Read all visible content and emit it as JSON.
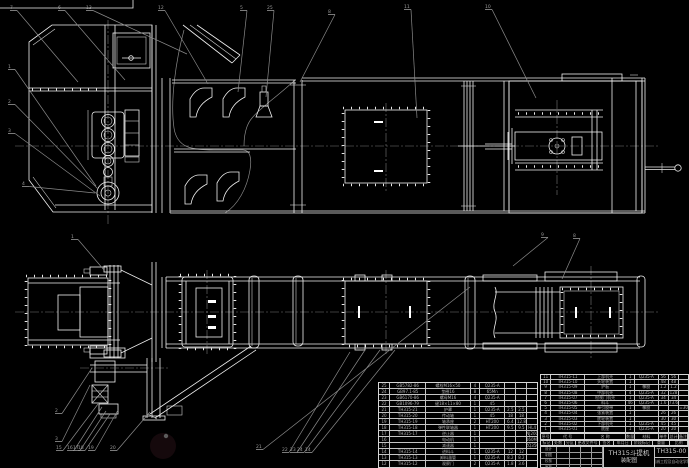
{
  "sheet": {
    "background": "#000000",
    "line_color": "#f0f0f0",
    "leader_color": "#8a8a8a",
    "watermark_color": "#463339"
  },
  "title_block": {
    "drawing_title": "TH315斗提机",
    "drawing_subtitle": "装配图",
    "drawing_number": "TH315-00",
    "organization": "机械工程及自动化学院",
    "sign_rows": [
      "设计",
      "制图",
      "校核",
      "审核"
    ],
    "revision_cells": [
      "标记",
      "处数",
      "分区",
      "更改文件号",
      "签名",
      "年月日",
      "阶段标记",
      "重量",
      "比例"
    ]
  },
  "bom_headers": [
    "序号",
    "代 号",
    "名 称",
    "数量",
    "材料",
    "单件",
    "总计",
    "备注"
  ],
  "bom_right_rows": [
    [
      "11",
      "TH315-11",
      "上部机壳",
      "1",
      "Q235-A",
      "56",
      "56",
      ""
    ],
    [
      "10",
      "TH315-10",
      "头轮装置",
      "1",
      "",
      "48",
      "48",
      ""
    ],
    [
      "9",
      "TH315-09",
      "护板",
      "1",
      "橡胶",
      "1.2",
      "1.2",
      ""
    ],
    [
      "8",
      "TH315-08",
      "中部机壳",
      "4",
      "Q235-A",
      "32",
      "128",
      ""
    ],
    [
      "7",
      "TH315-07",
      "检视门机壳",
      "1",
      "Q235-A",
      "34",
      "34",
      ""
    ],
    [
      "6",
      "TH315-06",
      "料斗",
      "46",
      "Q235-A",
      "1.6",
      "73.6",
      ""
    ],
    [
      "5",
      "TH315-05",
      "牵引胶带",
      "1",
      "橡胶",
      "",
      "",
      "B=300"
    ],
    [
      "4",
      "TH315-04",
      "张紧装置",
      "1",
      "",
      "26",
      "26",
      ""
    ],
    [
      "3",
      "TH315-03",
      "底轮装置",
      "1",
      "",
      "30",
      "30",
      ""
    ],
    [
      "2",
      "TH315-02",
      "下部机壳",
      "1",
      "Q235-A",
      "45",
      "45",
      ""
    ],
    [
      "1",
      "TH315-01",
      "底座",
      "1",
      "Q235-A",
      "20",
      "20",
      ""
    ]
  ],
  "bom_left_rows": [
    [
      "25",
      "GB5782-86",
      "螺栓M16×50",
      "4",
      "Q235-A",
      "",
      "",
      ""
    ],
    [
      "24",
      "GB97.1-85",
      "垫圈16",
      "8",
      "65Mn",
      "",
      "",
      ""
    ],
    [
      "23",
      "GB6170-86",
      "螺母M16",
      "4",
      "Q235-A",
      "",
      "",
      ""
    ],
    [
      "22",
      "GB1096-79",
      "键18×11×80",
      "1",
      "45",
      "",
      "",
      ""
    ],
    [
      "21",
      "TH315-21",
      "护罩",
      "1",
      "Q235-A",
      "2.5",
      "2.5",
      ""
    ],
    [
      "20",
      "TH315-20",
      "传动轴",
      "1",
      "45",
      "18",
      "18",
      ""
    ],
    [
      "19",
      "TH315-19",
      "轴承座",
      "2",
      "HT200",
      "6.4",
      "12.8",
      ""
    ],
    [
      "18",
      "TH315-18",
      "弹性联轴器",
      "1",
      "HT200",
      "9.5",
      "9.5",
      "HL4"
    ],
    [
      "17",
      "TH315-17",
      "逆止器",
      "1",
      "",
      "",
      "",
      "NJ200"
    ],
    [
      "16",
      "",
      "电动机",
      "1",
      "",
      "",
      "",
      "Y160M-4"
    ],
    [
      "15",
      "",
      "减速器",
      "1",
      "",
      "",
      "",
      "ZQ350"
    ],
    [
      "14",
      "TH315-14",
      "进料斗",
      "1",
      "Q235-A",
      "12",
      "12",
      ""
    ],
    [
      "13",
      "TH315-13",
      "卸料溜管",
      "1",
      "Q235-A",
      "8.2",
      "8.2",
      ""
    ],
    [
      "12",
      "TH315-12",
      "观察门",
      "2",
      "Q235-A",
      "1.8",
      "3.6",
      ""
    ]
  ],
  "balloons": [
    {
      "label": "7",
      "x": 12,
      "y": 9,
      "tx": 78,
      "ty": 82
    },
    {
      "label": "6",
      "x": 60,
      "y": 9,
      "tx": 125,
      "ty": 80
    },
    {
      "label": "13",
      "x": 88,
      "y": 9,
      "tx": 187,
      "ty": 54
    },
    {
      "label": "12",
      "x": 160,
      "y": 9,
      "tx": 208,
      "ty": 84
    },
    {
      "label": "5",
      "x": 242,
      "y": 9,
      "tx": 238,
      "ty": 92
    },
    {
      "label": "25",
      "x": 269,
      "y": 9,
      "tx": 266,
      "ty": 97
    },
    {
      "label": "8",
      "x": 330,
      "y": 13,
      "tx": 300,
      "ty": 82
    },
    {
      "label": "11",
      "x": 406,
      "y": 8,
      "tx": 417,
      "ty": 118
    },
    {
      "label": "10",
      "x": 487,
      "y": 8,
      "tx": 536,
      "ty": 98
    },
    {
      "label": "1",
      "x": 10,
      "y": 68,
      "tx": 96,
      "ty": 186
    },
    {
      "label": "2",
      "x": 10,
      "y": 103,
      "tx": 98,
      "ty": 189
    },
    {
      "label": "3",
      "x": 10,
      "y": 132,
      "tx": 100,
      "ty": 196
    },
    {
      "label": "4",
      "x": 24,
      "y": 185,
      "tx": 95,
      "ty": 193
    },
    {
      "label": "9",
      "x": 543,
      "y": 236,
      "tx": 513,
      "ty": 266
    },
    {
      "label": "8",
      "x": 575,
      "y": 237,
      "tx": 562,
      "ty": 279
    },
    {
      "label": "1",
      "x": 73,
      "y": 238,
      "tx": 104,
      "ty": 270
    },
    {
      "label": "2",
      "x": 57,
      "y": 412,
      "tx": 92,
      "ty": 368
    },
    {
      "label": "3",
      "x": 57,
      "y": 440,
      "tx": 90,
      "ty": 385
    },
    {
      "label": "15",
      "x": 58,
      "y": 449,
      "tx": 98,
      "ty": 404
    },
    {
      "label": "16",
      "x": 69,
      "y": 449,
      "tx": 102,
      "ty": 407
    },
    {
      "label": "17",
      "x": 75,
      "y": 449,
      "tx": 106,
      "ty": 411
    },
    {
      "label": "18",
      "x": 80,
      "y": 449,
      "tx": 110,
      "ty": 414
    },
    {
      "label": "19",
      "x": 90,
      "y": 449,
      "tx": 118,
      "ty": 410
    },
    {
      "label": "20",
      "x": 112,
      "y": 449,
      "tx": 150,
      "ty": 412
    },
    {
      "label": "21",
      "x": 258,
      "y": 448,
      "tx": 470,
      "ty": 287
    },
    {
      "label": "22",
      "x": 284,
      "y": 451,
      "tx": 350,
      "ty": 352
    },
    {
      "label": "23",
      "x": 292,
      "y": 451,
      "tx": 365,
      "ty": 350
    },
    {
      "label": "24",
      "x": 299,
      "y": 451,
      "tx": 380,
      "ty": 350
    },
    {
      "label": "14",
      "x": 307,
      "y": 451,
      "tx": 395,
      "ty": 350
    }
  ]
}
